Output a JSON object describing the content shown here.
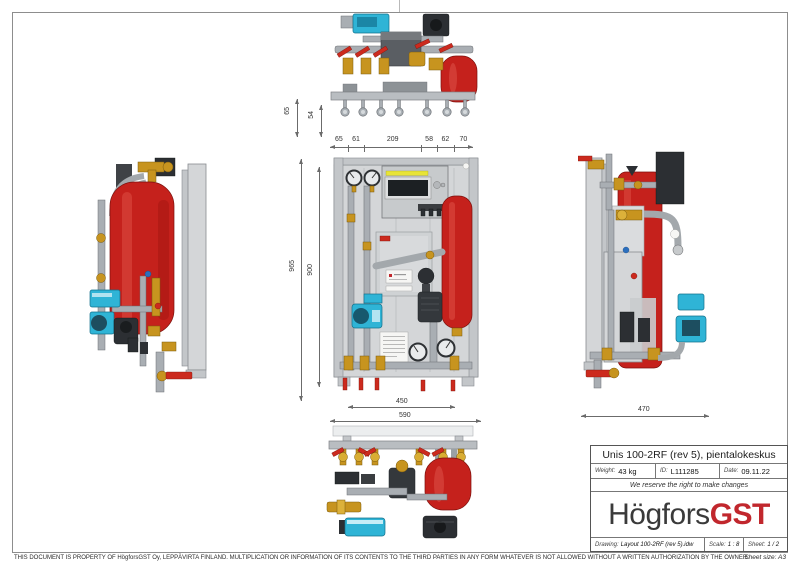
{
  "title_block": {
    "title": "Unis 100-2RF (rev 5), pientalokeskus",
    "weight": {
      "label": "Weight:",
      "value": "43 kg"
    },
    "id": {
      "label": "ID:",
      "value": "L111285"
    },
    "date": {
      "label": "Date:",
      "value": "09.11.22"
    },
    "notice": "We reserve the right to make changes",
    "logo": {
      "text_black": "Högfors",
      "text_red": "GST"
    },
    "drawing": {
      "label": "Drawing:",
      "value": "Layout 100-2RF (rev 5).idw"
    },
    "scale": {
      "label": "Scale:",
      "value": "1 : 8"
    },
    "sheet": {
      "label": "Sheet:",
      "value": "1 / 2"
    }
  },
  "sheet_size": "Sheet size: A3",
  "disclaimer": "THIS DOCUMENT IS PROPERTY OF HögforsGST Oy, LEPPÄVIRTA FINLAND. MULTIPLICATION OR INFORMATION OF ITS CONTENTS TO THE THIRD PARTIES IN ANY FORM WHATEVER IS NOT ALLOWED WITHOUT A WRITTEN AUTHORIZATION BY THE OWNER.",
  "dimensions": {
    "top_drop_outer": "65",
    "top_drop_inner": "54",
    "top_row": [
      "65",
      "61",
      "209",
      "58",
      "62",
      "70"
    ],
    "front_height_outer": "965",
    "front_height_inner": "900",
    "front_width_inner": "450",
    "front_width_outer": "590",
    "side_depth": "470"
  },
  "colors": {
    "vessel_red": "#c5211c",
    "pump_cyan": "#2fb4d6",
    "brass": "#c7941f",
    "handle_red": "#cc2a1e",
    "panel_gray": "#d4d6d8",
    "steel_gray": "#b9bdc1",
    "logo_red": "#c1272d",
    "logo_dark": "#3a3a3a"
  }
}
